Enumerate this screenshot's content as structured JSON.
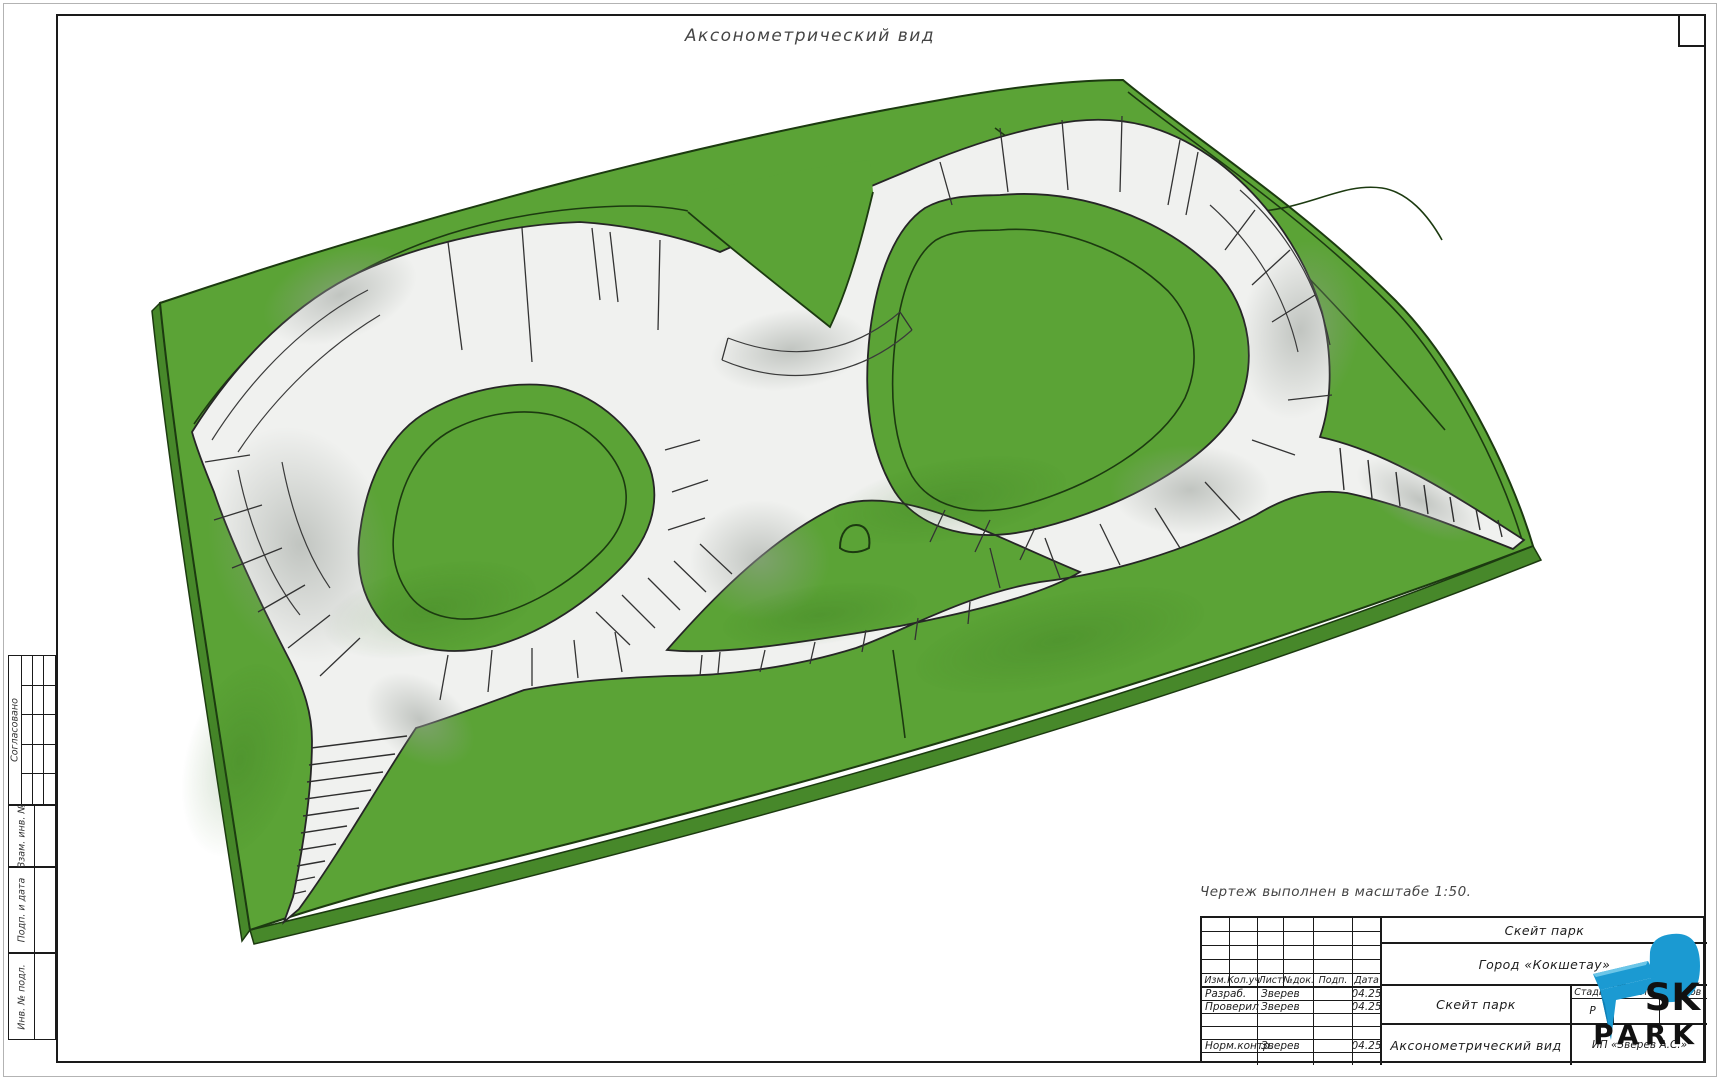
{
  "drawing_title": "Аксонометрический вид",
  "scale_note": "Чертеж выполнен в масштабе 1:50.",
  "sidebar": {
    "approved": "Согласовано",
    "vzam": "Взам. инв. №",
    "podp": "Подп. и дата",
    "inv": "Инв. № подл."
  },
  "title_block": {
    "cols": {
      "izm": "Изм.",
      "kol": "Кол.уч",
      "list": "Лист",
      "ndok": "№док.",
      "podp": "Подп.",
      "data": "Дата"
    },
    "rows": [
      {
        "role": "Разраб.",
        "name": "Зверев",
        "sign": "",
        "date": "04.25"
      },
      {
        "role": "Проверил",
        "name": "Зверев",
        "sign": "",
        "date": "04.25"
      },
      {
        "role": "",
        "name": "",
        "sign": "",
        "date": ""
      },
      {
        "role": "",
        "name": "",
        "sign": "",
        "date": ""
      },
      {
        "role": "Норм.контр.",
        "name": "Зверев",
        "sign": "",
        "date": "04.25"
      },
      {
        "role": "",
        "name": "",
        "sign": "",
        "date": ""
      }
    ],
    "project": "Скейт парк",
    "city": "Город «Кокшетау»",
    "object": "Скейт парк",
    "view": "Аксонометрический вид",
    "stage_label": "Стадия",
    "sheet_label": "Лист",
    "sheets_label": "Листов",
    "stage": "Р",
    "company": "ИП «Зверев А.С.»"
  },
  "logo": {
    "sk": "SK",
    "park": "PARK"
  },
  "colors": {
    "grass": "#5ba336",
    "grass-dark": "#47882a",
    "track": "#f0f1ef",
    "line": "#1c3a10",
    "ink": "#1a1a1a",
    "logo-blue": "#1b9ad2"
  }
}
